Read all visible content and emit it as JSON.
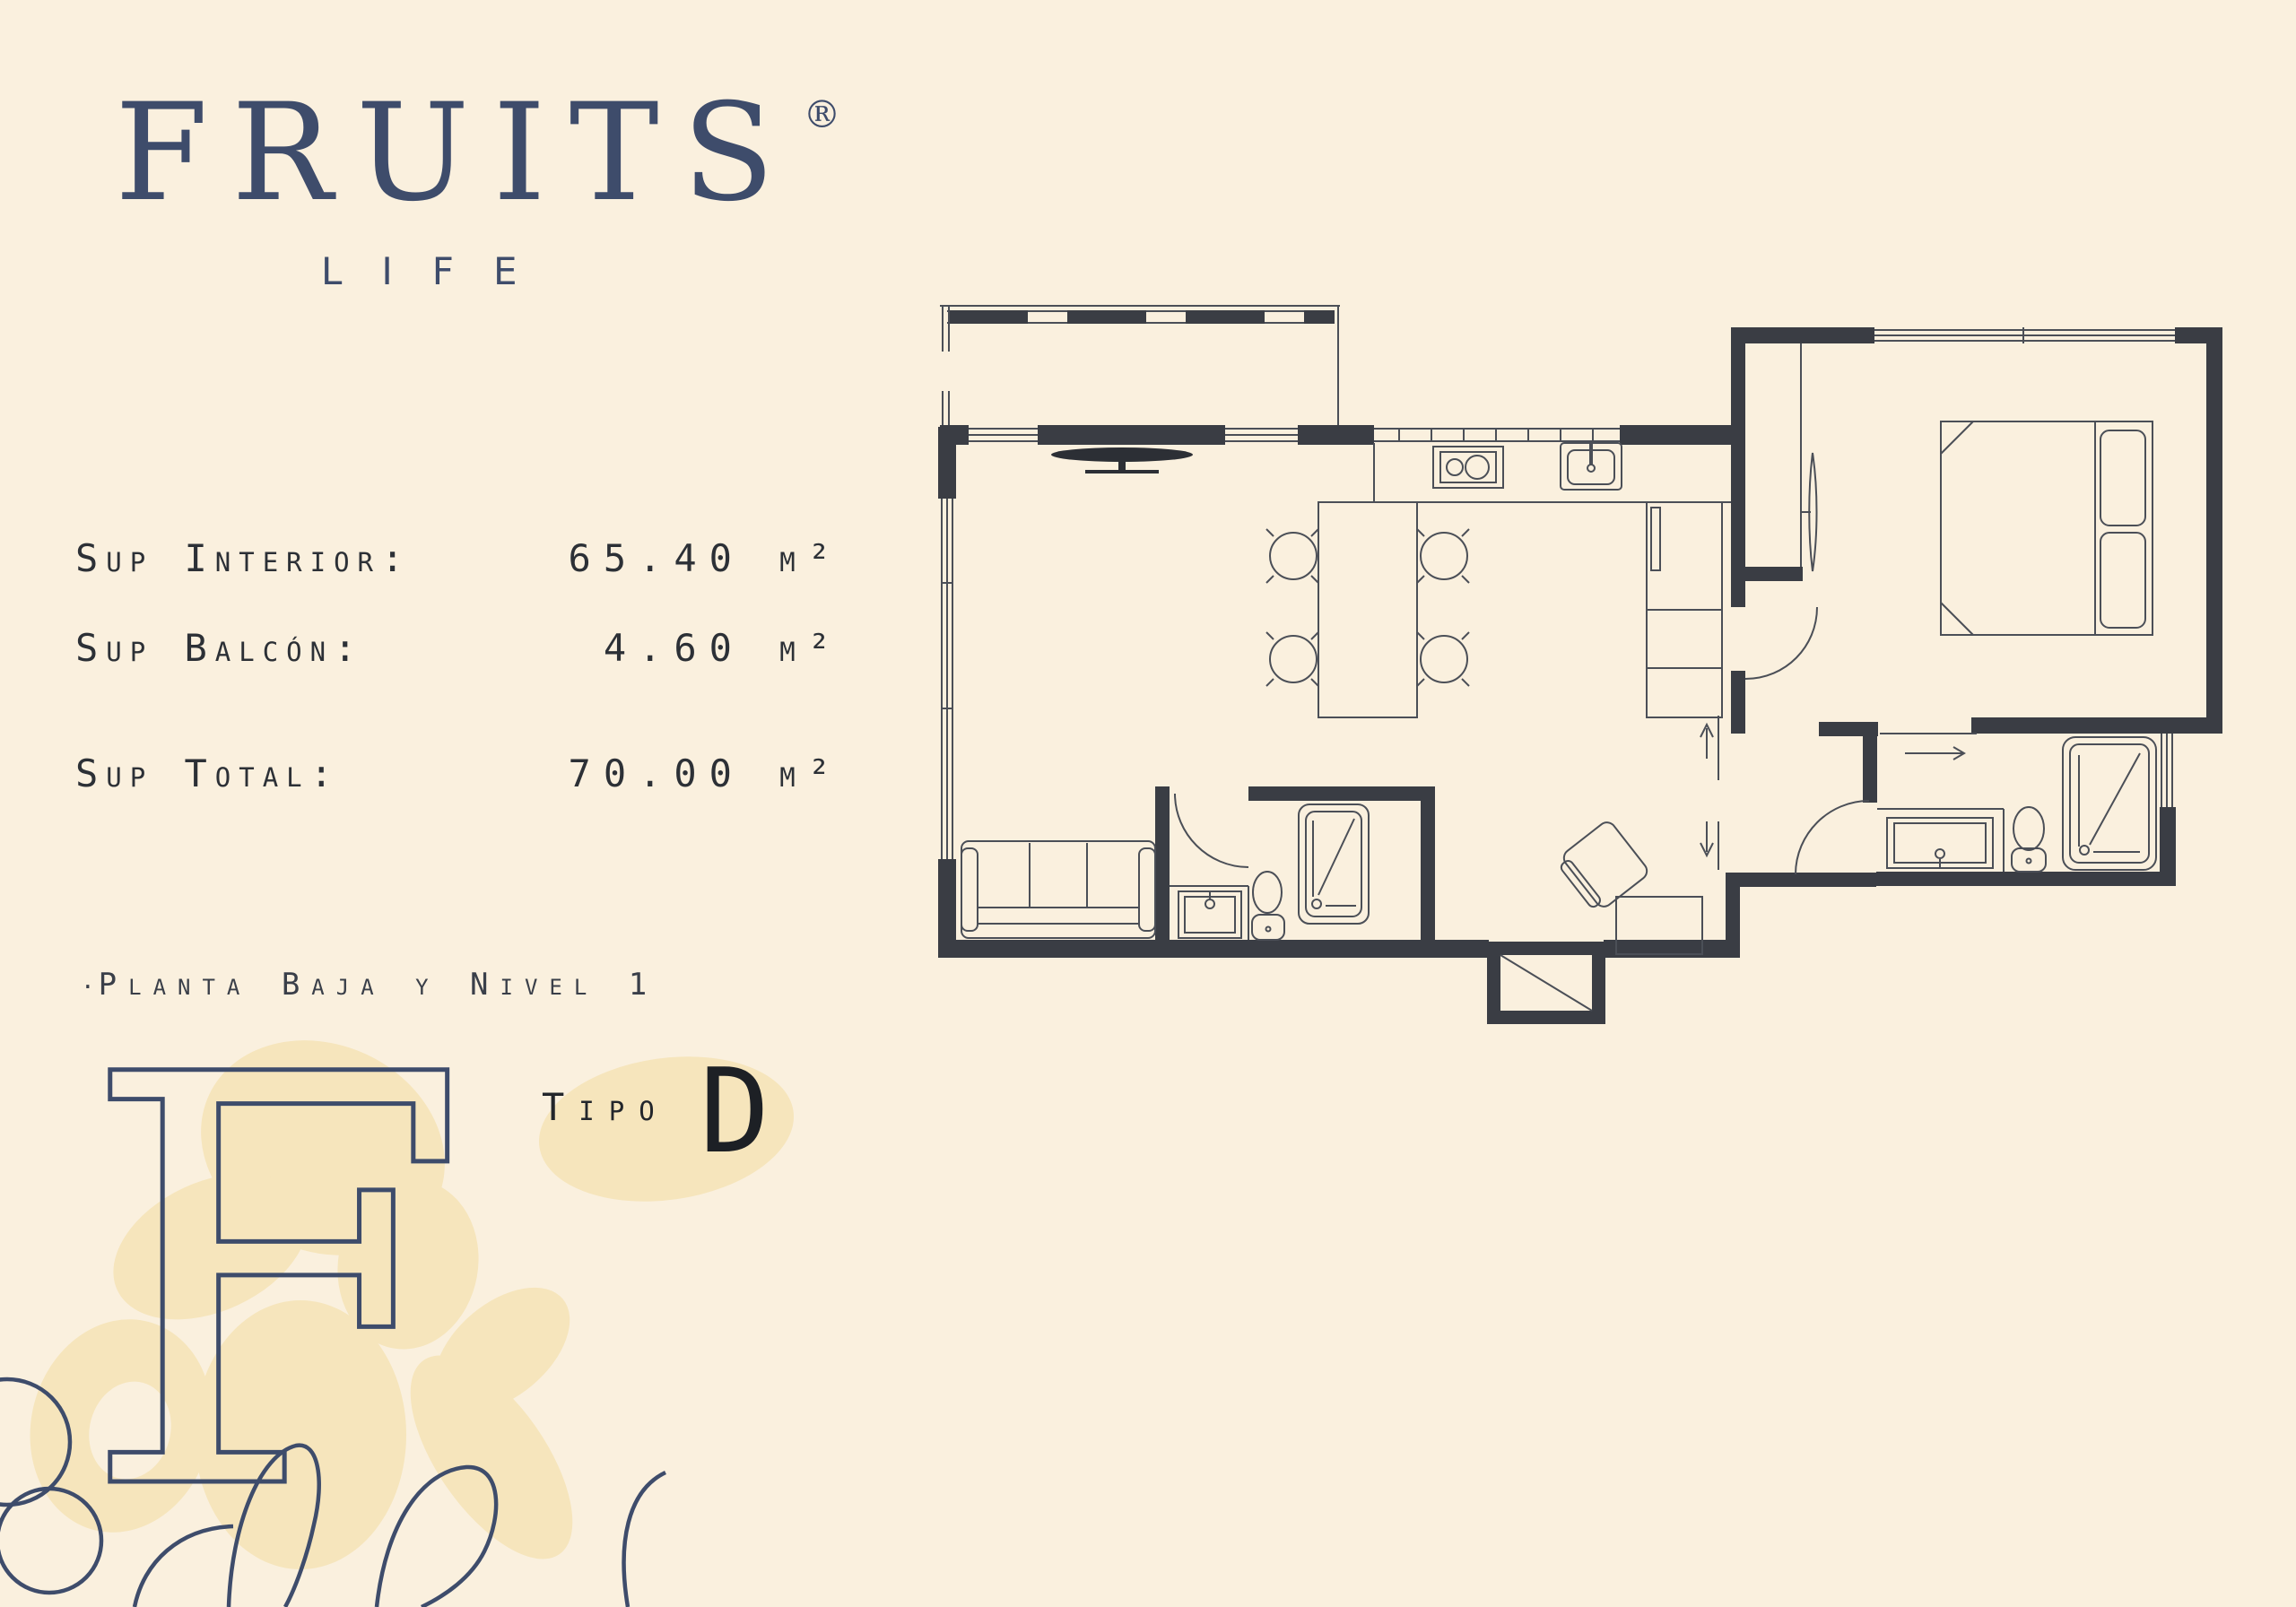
{
  "background_color": "#faf0de",
  "brand": {
    "name": "FRUITS",
    "registered_mark": "®",
    "tagline": "LIFE",
    "color": "#3e4c6b"
  },
  "specs": {
    "rows": [
      {
        "label": "Sup Interior:",
        "value": "65.40 m²"
      },
      {
        "label": "Sup Balcón:",
        "value": "4.60 m²"
      },
      {
        "label": "Sup Total:",
        "value": "70.00 m²"
      }
    ]
  },
  "level_note": {
    "bullet": "·",
    "text": "Planta Baja y Nivel 1"
  },
  "unit_type": {
    "label": "Tipo",
    "letter": "D",
    "highlight_color": "#f6e5bc"
  },
  "floorplan": {
    "wall_color": "#3a3d44",
    "line_color": "#4b4f57",
    "features": [
      "balcony",
      "living-room",
      "tv",
      "sofa",
      "dining-table",
      "kitchen-stove",
      "kitchen-sink",
      "cabinets",
      "stairs",
      "hallway",
      "bedroom",
      "bed",
      "wardrobe-mirror",
      "bathroom",
      "ensuite-bathroom",
      "shower",
      "toilet",
      "vanity-sink",
      "armchair",
      "service-shaft",
      "entry-arrow"
    ]
  },
  "artwork": {
    "monogram_letter": "F",
    "accent_color": "#f6e5bc",
    "outline_color": "#3e4c6b"
  }
}
